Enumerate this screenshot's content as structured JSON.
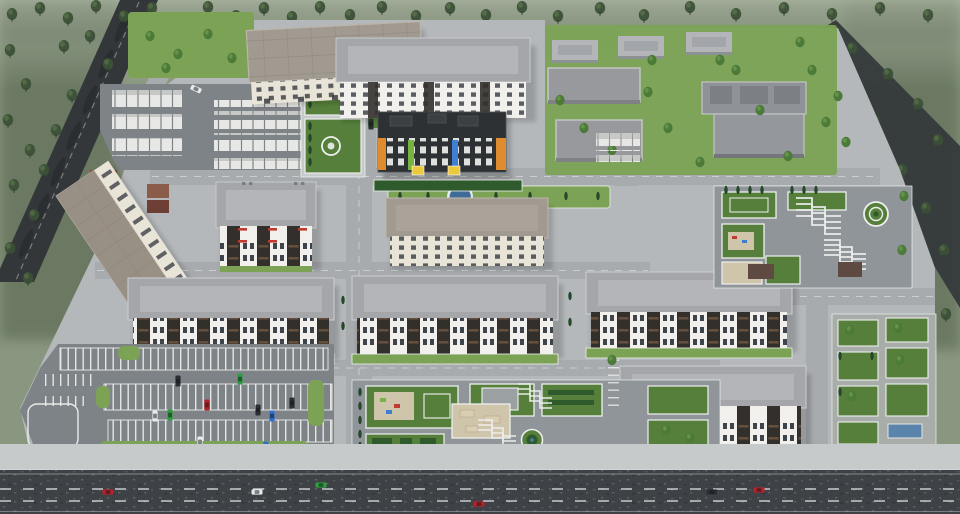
{
  "meta": {
    "title": "Aerial 3D render of a residential complex master plan",
    "view": "isometric aerial",
    "time_of_day": "overcast daylight, hazy"
  },
  "palette": {
    "haze": "#8a9780",
    "haze-light": "#a9b299",
    "forest": "#46573f",
    "tree": "#3c5138",
    "tree-bright": "#4c7a38",
    "cypress": "#24472a",
    "lawn": "#7ca355",
    "lawn-dark": "#567f3b",
    "hedge": "#2e5a2c",
    "sand": "#cfc5ab",
    "pavement": "#b4b8ba",
    "pavement-light": "#c7cacb",
    "plaza": "#8f9599",
    "road-inner": "#a7abae",
    "road-dark": "#33373a",
    "road-main": "#3e4246",
    "asphalt": "#7e8387",
    "line": "#e9ebe9",
    "roof-gray": "#a4a6a9",
    "roof-hip": "#b3b5b8",
    "roof-warm": "#a19a90",
    "facade-white": "#f1f0ed",
    "facade-cream": "#e9e4d8",
    "facade-dark": "#332f2b",
    "balcony": "#6b543f",
    "window": "#3f444a",
    "kinder-dark": "#2e3134",
    "orange": "#df8c2f",
    "yellow": "#ecc83d",
    "green-accent": "#79b33f",
    "blue-accent": "#3d7fd2",
    "red-accent": "#c23a2f",
    "water": "#4d7dad",
    "garage-white": "#e7e8e5",
    "container": "#7c4a3c",
    "car-red": "#b5232a",
    "car-green": "#2e9e3f",
    "car-blue": "#2f6fd0",
    "car-white": "#e8eaec",
    "car-dark": "#2c2f33"
  },
  "scene": {
    "buildings": [
      {
        "id": "block-a",
        "label": "5-storey apartment slab, flat warm-grey roof, cream facade"
      },
      {
        "id": "block-b",
        "label": "6-storey apartment block, hipped grey roof, dark entrance strips"
      },
      {
        "id": "kindergarten",
        "label": "kindergarten, dark facade with orange / green / blue strips and yellow entrances"
      },
      {
        "id": "block-d",
        "label": "5-storey rotated slab, flat roof, west edge of site"
      },
      {
        "id": "block-e",
        "label": "5-storey block with red balcony accents"
      },
      {
        "id": "block-f",
        "label": "5-storey cream slab, hipped warm roof"
      },
      {
        "id": "block-g1",
        "label": "6-storey gallery block, white piers and dark balcony bays"
      },
      {
        "id": "block-g2",
        "label": "6-storey gallery block, white piers and dark balcony bays"
      },
      {
        "id": "block-g3",
        "label": "6-storey gallery block, white piers and dark balcony bays"
      },
      {
        "id": "block-h",
        "label": "6-storey gallery block, south-east"
      },
      {
        "id": "school",
        "label": "flat-roof school complex with recessed roof courts"
      },
      {
        "id": "pavilions",
        "label": "three small hip-roof pavilions on the school lawn"
      }
    ],
    "amenities": [
      "central courtyard park with playgrounds, stepped paths and round topiary",
      "north-east ornamental park with spiral topiary and terraced paths",
      "south-east hedge-square garden with blue pergola",
      "west ornamental garden with circular hedge rings",
      "round fountain with blue water",
      "garage yard with rows of white garages",
      "south-west surface parking lot with green islands",
      "tree-lined boulevard on the west, forest belts on three sides"
    ]
  },
  "vehicles": {
    "main-road": [
      {
        "color": "red",
        "x": 108,
        "y": 492,
        "rot": 0
      },
      {
        "color": "white",
        "x": 257,
        "y": 492,
        "rot": 0
      },
      {
        "color": "green",
        "x": 321,
        "y": 485,
        "rot": 0
      },
      {
        "color": "red",
        "x": 479,
        "y": 504,
        "rot": 0
      },
      {
        "color": "dark",
        "x": 712,
        "y": 492,
        "rot": 0
      },
      {
        "color": "red",
        "x": 759,
        "y": 490,
        "rot": 0
      }
    ],
    "parking-lot": [
      {
        "color": "green",
        "x": 240,
        "y": 379,
        "rot": 90
      },
      {
        "color": "dark",
        "x": 178,
        "y": 381,
        "rot": 90
      },
      {
        "color": "red",
        "x": 207,
        "y": 405,
        "rot": 90
      },
      {
        "color": "dark",
        "x": 258,
        "y": 410,
        "rot": 90
      },
      {
        "color": "dark",
        "x": 292,
        "y": 403,
        "rot": 90
      },
      {
        "color": "white",
        "x": 155,
        "y": 416,
        "rot": 90
      },
      {
        "color": "green",
        "x": 170,
        "y": 415,
        "rot": 90
      },
      {
        "color": "blue",
        "x": 272,
        "y": 416,
        "rot": 90
      },
      {
        "color": "white",
        "x": 200,
        "y": 442,
        "rot": 90
      },
      {
        "color": "blue",
        "x": 266,
        "y": 447,
        "rot": 90
      }
    ],
    "service": [
      {
        "color": "white",
        "x": 196,
        "y": 89,
        "rot": 25
      },
      {
        "color": "dark",
        "x": 371,
        "y": 124,
        "rot": 90
      }
    ]
  }
}
